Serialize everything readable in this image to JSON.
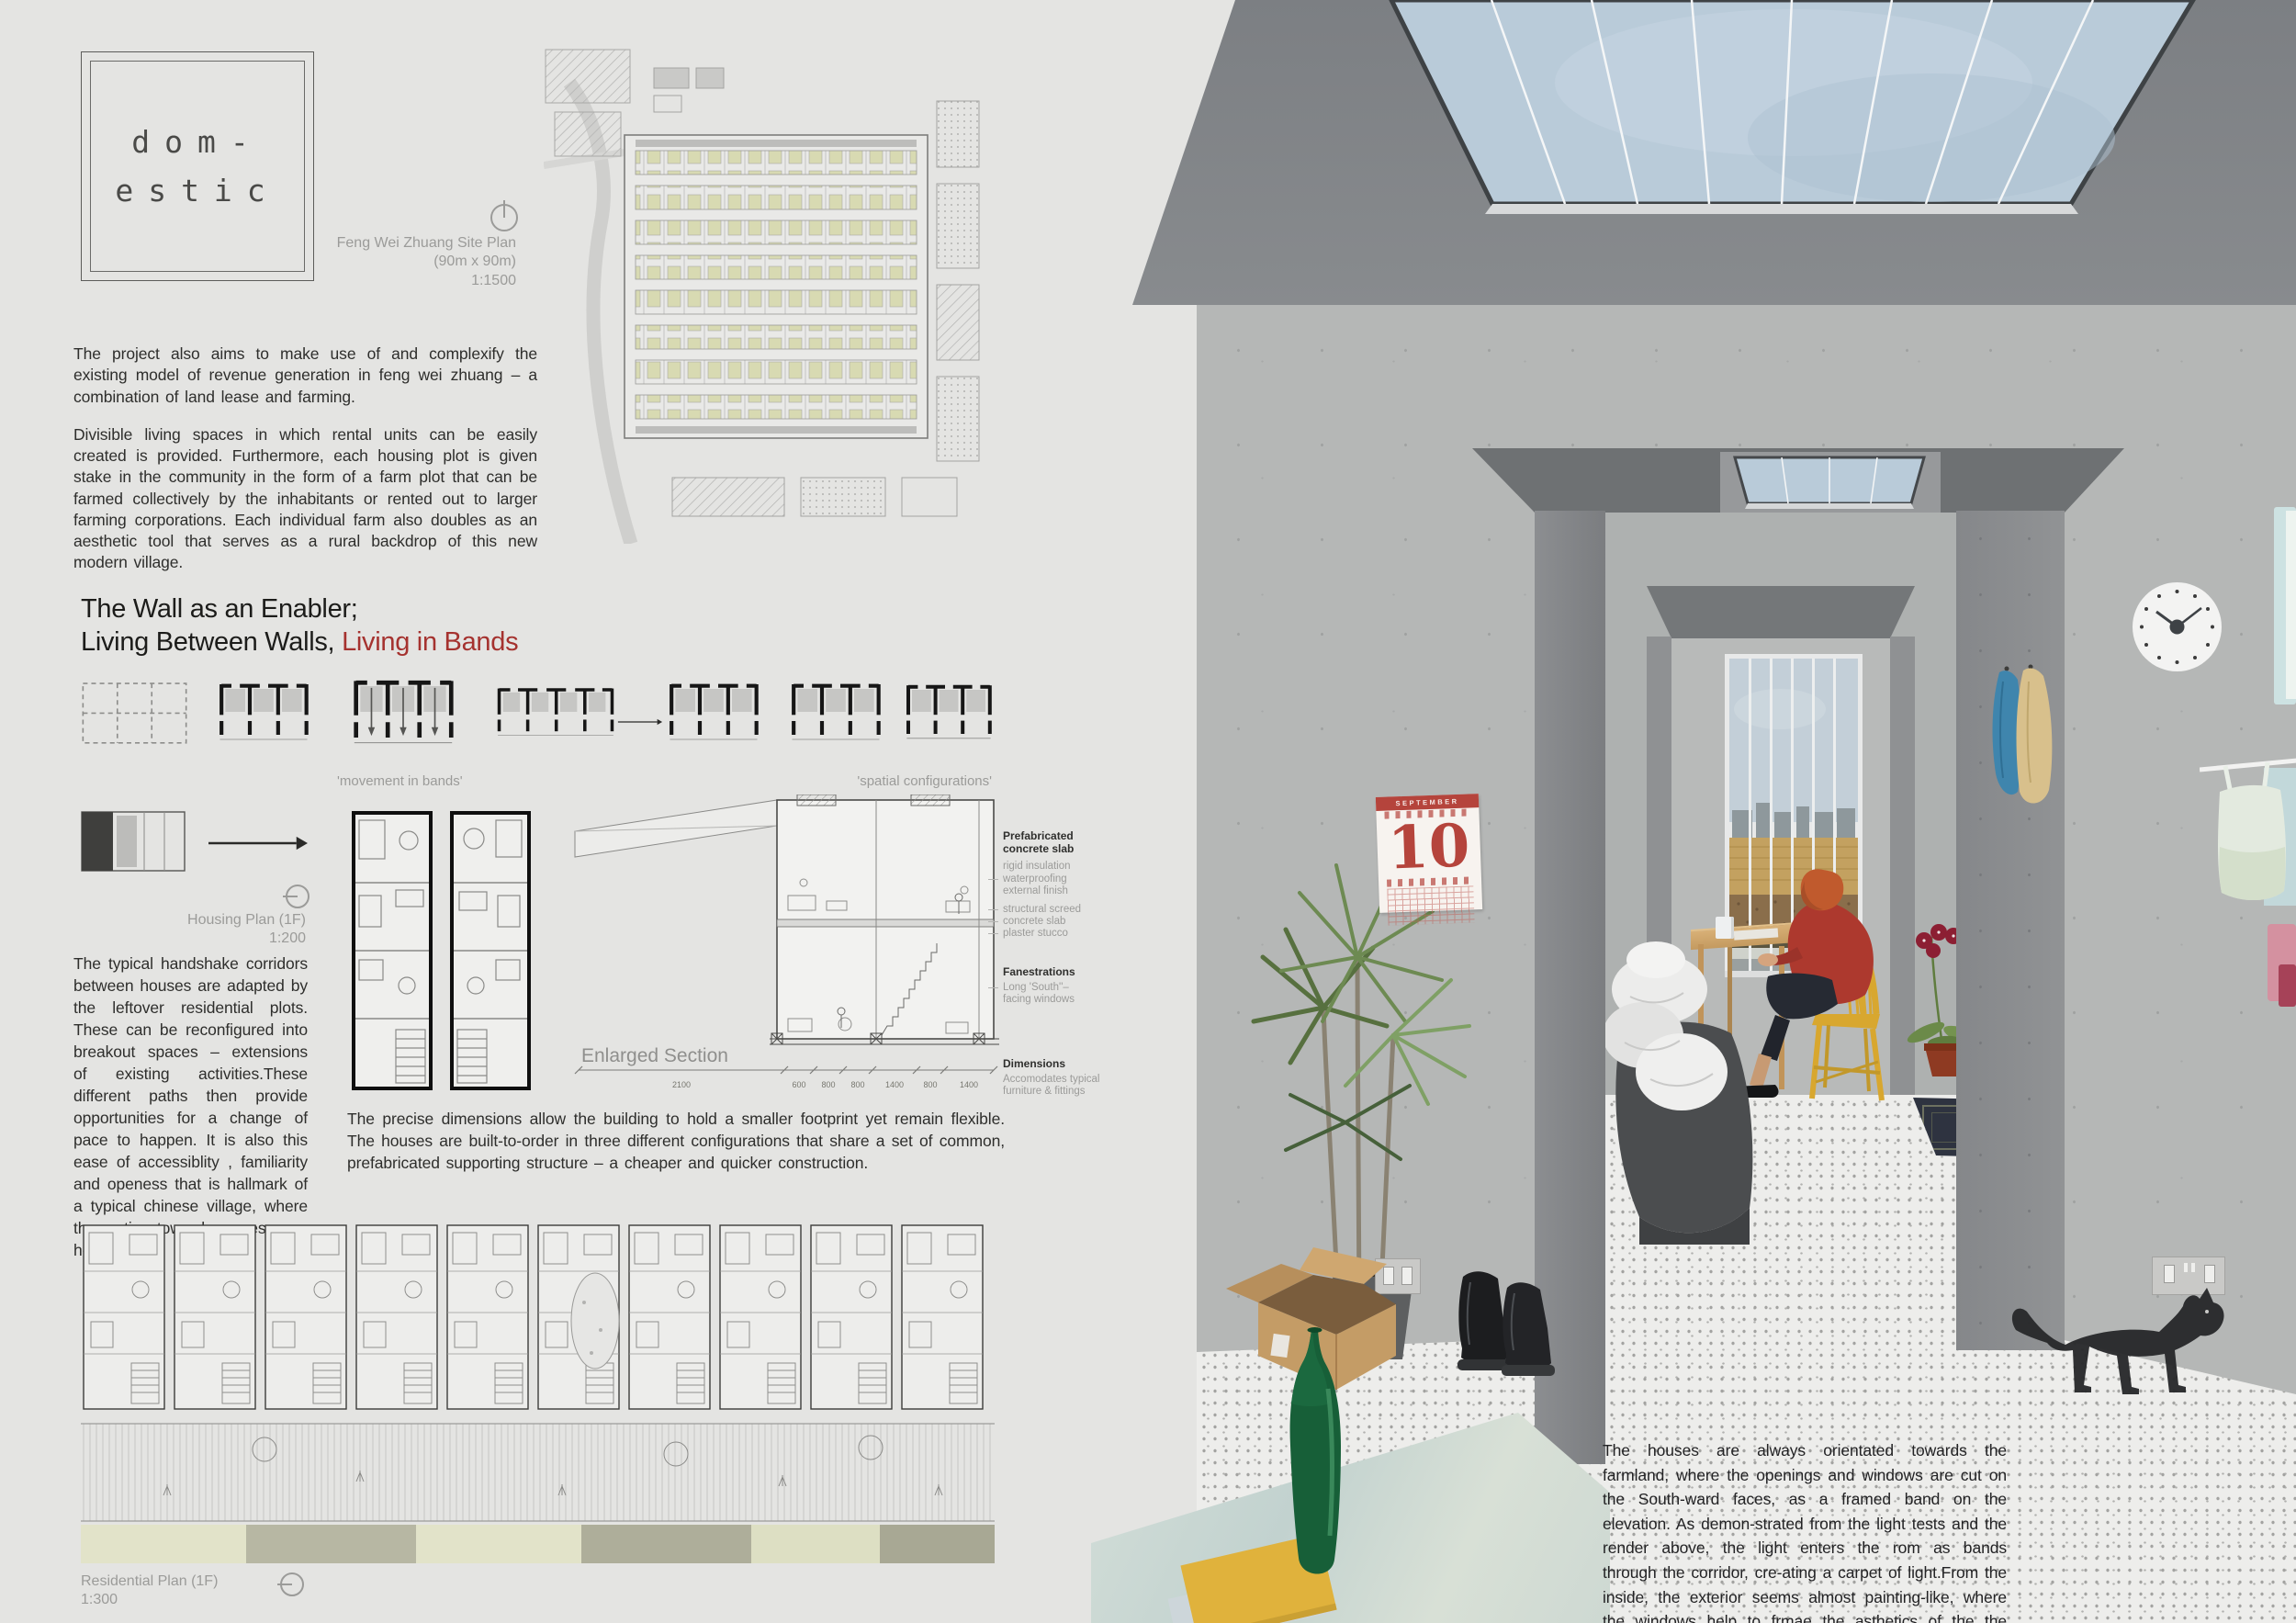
{
  "poster": {
    "logo": {
      "line1": "dom-",
      "line2": "estic"
    },
    "site_plan": {
      "line1": "Feng Wei Zhuang Site Plan",
      "line2": "(90m x 90m)",
      "line3": "1:1500"
    },
    "intro": [
      "The project also aims to make use of and complexify the existing model of revenue generation in feng wei zhuang – a combination of land lease and farming.",
      "Divisible living spaces in which rental units can be easily created is provided. Furthermore, each housing plot is given stake in the community in the form of a farm plot that can be farmed collectively by the inhabitants or rented out to larger farming corporations. Each individual farm also doubles as an aesthetic tool that serves as a rural backdrop of this new modern village."
    ],
    "heading": {
      "line1": "The Wall as an Enabler;",
      "line2_black": "Living Between Walls, ",
      "line2_red": "Living in Bands"
    },
    "labels": {
      "movement": "'movement in bands'",
      "spatial": "'spatial configurations'"
    },
    "housing_plan": {
      "title": "Housing Plan (1F)",
      "scale": "1:200"
    },
    "handshake": "The typical handshake corridors between houses are adapted by the leftover residential plots. These can be reconfigured into breakout spaces –  extensions of existing activities.These different paths then provide opportunities for a change of pace to happen. It is also this ease of accessiblity , familiarity and openess that is hallmark of a typical chinese village, where the entire town becomes your home.",
    "section": {
      "label": "Enlarged Section",
      "dims": [
        "2100",
        "600",
        "800",
        "800",
        "1400",
        "800",
        "1400"
      ]
    },
    "annotations": {
      "a1_title1": "Prefabricated",
      "a1_title2": "concrete slab",
      "a1_l1": "rigid insulation",
      "a1_l2": "waterproofing",
      "a1_l3": "external finish",
      "a1_l4": "structural screed",
      "a1_l5": "concrete slab",
      "a1_l6": "plaster stucco",
      "a2_title": "Fanestrations",
      "a2_l1": "Long 'South''–",
      "a2_l2": "facing windows",
      "a3_title": "Dimensions",
      "a3_l1": "Accomodates typical",
      "a3_l2": "furniture & fittings"
    },
    "precise": "The precise dimensions allow the building to hold a smaller footprint yet remain flexible. The houses are built-to-order in three different configurations that share a set of common, prefabricated supporting structure – a cheaper and quicker construction.",
    "residential_plan": {
      "title": "Residential Plan (1F)",
      "scale": "1:300"
    }
  },
  "render": {
    "calendar": {
      "month": "SEPTEMBER",
      "day": "10"
    },
    "caption": "The houses are always orientated towards the farmland, where the openings and windows are cut on the South-ward faces, as a framed band on the elevation. As demon-strated from the light tests and the render above, the light enters the rom as bands through the corridor, cre-ating a carpet of light.From the inside, the exterior seems almost painting-like, where the windows help to frmae the asthetics of the the agricultural landscape outisde."
  },
  "colors": {
    "accent_red": "#a5322f",
    "skylight_blue": "#b9cbd9",
    "chair_yellow": "#d8a72f",
    "jacket_red": "#ad392e"
  }
}
